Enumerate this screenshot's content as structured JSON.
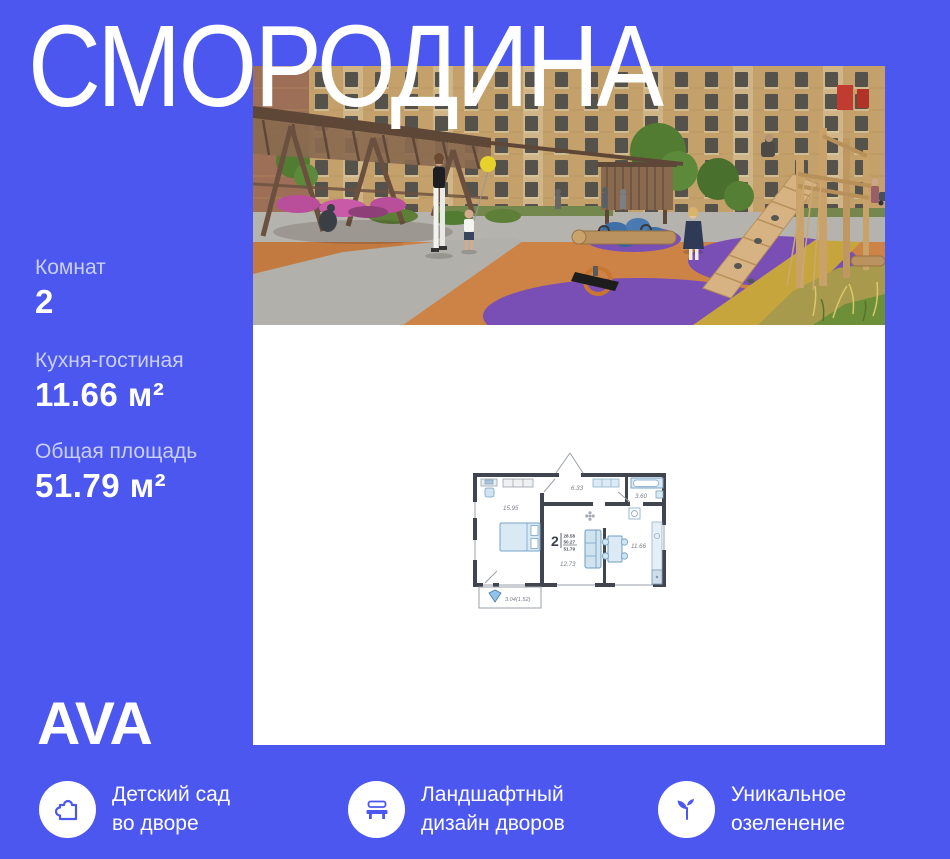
{
  "title": "СМОРОДИНА",
  "logo": "AVA",
  "stats": [
    {
      "label": "Комнат",
      "value": "2"
    },
    {
      "label": "Кухня-гостиная",
      "value": "11.66 м²"
    },
    {
      "label": "Общая площадь",
      "value": "51.79 м²"
    }
  ],
  "floorplan": {
    "bedroom_area": "15.95",
    "hall_area": "6.33",
    "bath_area": "3.60",
    "living_area": "12.73",
    "kitchen_area": "11.66",
    "balcony_area": "3.04(1.52)",
    "rooms_count": "2",
    "area_living_sum": "28.58",
    "area_without_balcony": "50.27",
    "area_total": "51.79"
  },
  "features": [
    {
      "icon": "puzzle-icon",
      "line1": "Детский сад",
      "line2": "во дворе"
    },
    {
      "icon": "bench-icon",
      "line1": "Ландшафтный",
      "line2": "дизайн дворов"
    },
    {
      "icon": "sprout-icon",
      "line1": "Уникальное",
      "line2": "озеленение"
    }
  ],
  "colors": {
    "background": "#4b57ef",
    "panel": "#ffffff",
    "value_text": "#ffffff",
    "muted_label": "#c9cff9",
    "plan_wall": "#40454f",
    "plan_furniture": "#d9eaf5"
  }
}
